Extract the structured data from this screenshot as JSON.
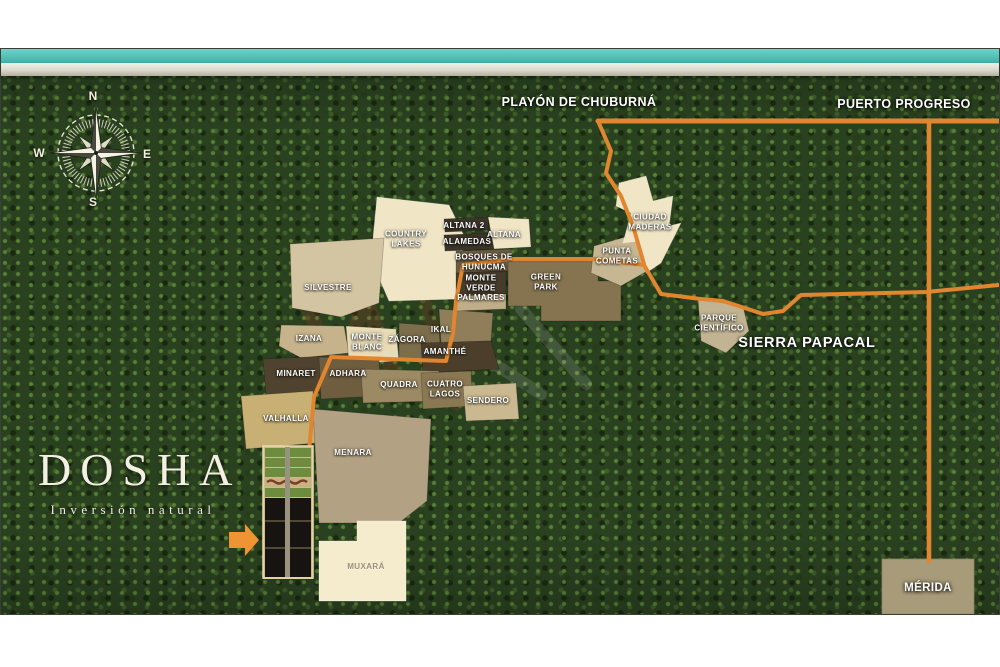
{
  "brand": {
    "name": "DOSHA",
    "tagline": "Inversión natural"
  },
  "compass": {
    "n": "N",
    "e": "E",
    "s": "S",
    "w": "W"
  },
  "map_labels": {
    "playon_de_chuburna": "PLAYÓN DE CHUBURNÁ",
    "puerto_progreso": "PUERTO PROGRESO",
    "sierra_papacal": "SIERRA PAPACAL",
    "merida": "MÉRIDA"
  },
  "parcels": [
    {
      "name": "COUNTRY LAKES"
    },
    {
      "name": "ALTANA 2"
    },
    {
      "name": "ALAMEDAS"
    },
    {
      "name": "ALTANA"
    },
    {
      "name": "BOSQUES DE HUNUCMA"
    },
    {
      "name": "MONTE VERDE"
    },
    {
      "name": "PALMARES"
    },
    {
      "name": "GREEN PARK"
    },
    {
      "name": "CIUDAD MADERAS"
    },
    {
      "name": "PUNTA COMETAS"
    },
    {
      "name": "PARQUE CIENTÍFICO"
    },
    {
      "name": "SILVESTRE"
    },
    {
      "name": "IZANA"
    },
    {
      "name": "MONTE BLANC"
    },
    {
      "name": "ZÁGORA"
    },
    {
      "name": "IKAL"
    },
    {
      "name": "AMANTHÉ"
    },
    {
      "name": "MINARET"
    },
    {
      "name": "ADHARA"
    },
    {
      "name": "QUADRA"
    },
    {
      "name": "CUATRO LAGOS"
    },
    {
      "name": "SENDERO"
    },
    {
      "name": "VALHALLA"
    },
    {
      "name": "MENARA"
    },
    {
      "name": "MUXARÁ"
    }
  ],
  "colors": {
    "road_orange": "#e1862e",
    "forest_green": "#2a4120",
    "ocean_teal": "#4fc0b5",
    "parcel_cream": "#f2e7c8",
    "arrow_orange": "#ef9433"
  }
}
